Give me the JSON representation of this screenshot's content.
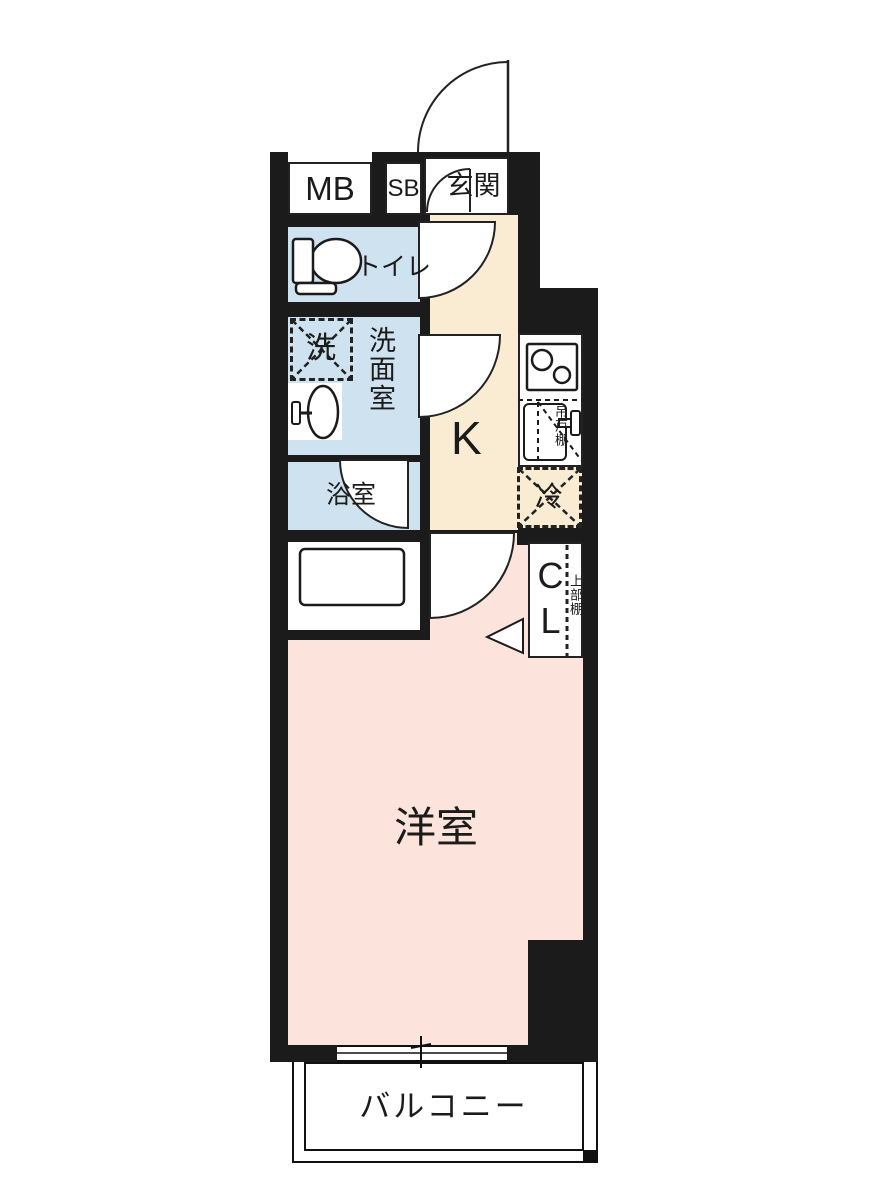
{
  "floorplan": {
    "title": "1K apartment floor plan",
    "labels": {
      "meter_box": "MB",
      "shoe_box": "SB",
      "entrance": "玄関",
      "toilet": "トイレ",
      "washing_machine": "洗",
      "washroom": "洗面室",
      "bathroom": "浴室",
      "kitchen": "K",
      "hanging_cupboard": "吊戸棚",
      "refrigerator": "冷",
      "closet": "CL",
      "upper_shelf": "上部棚",
      "western_room": "洋室",
      "balcony": "バルコニー"
    },
    "colors": {
      "wall": "#1b1b1b",
      "wet_area_floor": "#cfe2f0",
      "kitchen_floor": "#faecd3",
      "room_floor": "#fce4dc",
      "background": "#ffffff",
      "line": "#222222"
    }
  }
}
